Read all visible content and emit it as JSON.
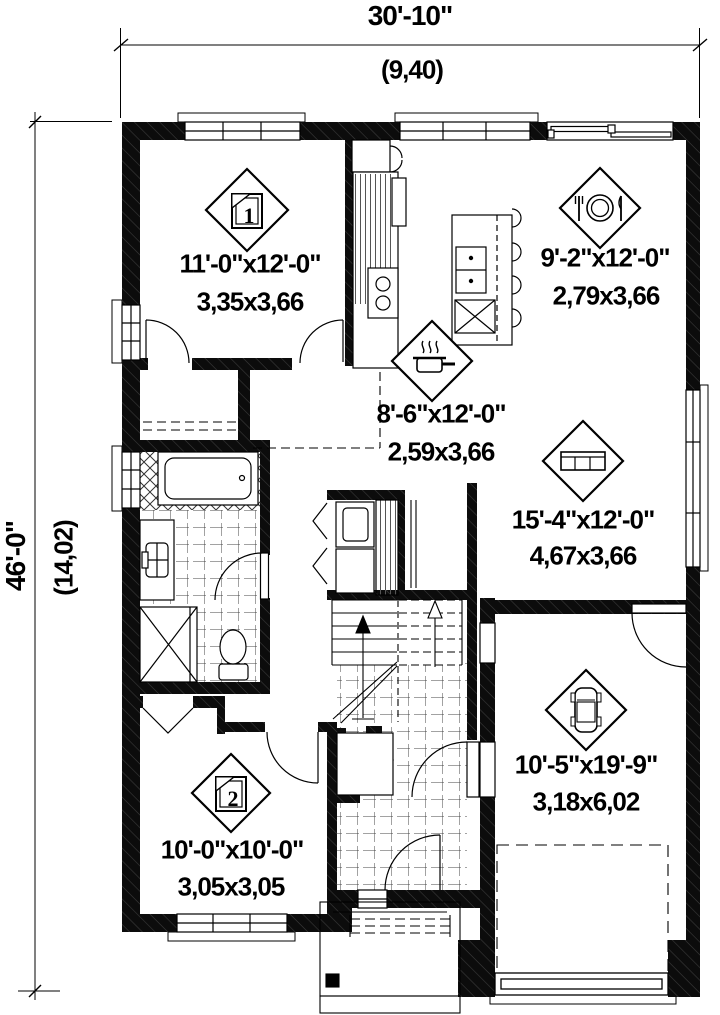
{
  "dimensions": {
    "width_imperial": "30'-10\"",
    "width_metric": "(9,40)",
    "height_imperial": "46'-0\"",
    "height_metric": "(14,02)"
  },
  "rooms": {
    "bedroom1": {
      "imperial": "11'-0\"x12'-0\"",
      "metric": "3,35x3,66",
      "number": "1"
    },
    "dining": {
      "imperial": "9'-2\"x12'-0\"",
      "metric": "2,79x3,66"
    },
    "kitchen": {
      "imperial": "8'-6\"x12'-0\"",
      "metric": "2,59x3,66"
    },
    "living": {
      "imperial": "15'-4\"x12'-0\"",
      "metric": "4,67x3,66"
    },
    "garage": {
      "imperial": "10'-5\"x19'-9\"",
      "metric": "3,18x6,02"
    },
    "bedroom2": {
      "imperial": "10'-0\"x10'-0\"",
      "metric": "3,05x3,05",
      "number": "2"
    }
  },
  "icons": {
    "bedroom1": "bed-1-icon",
    "dining": "dining-plate-icon",
    "kitchen": "cooking-pot-icon",
    "living": "sofa-icon",
    "garage": "car-icon",
    "bedroom2": "bed-2-icon"
  }
}
